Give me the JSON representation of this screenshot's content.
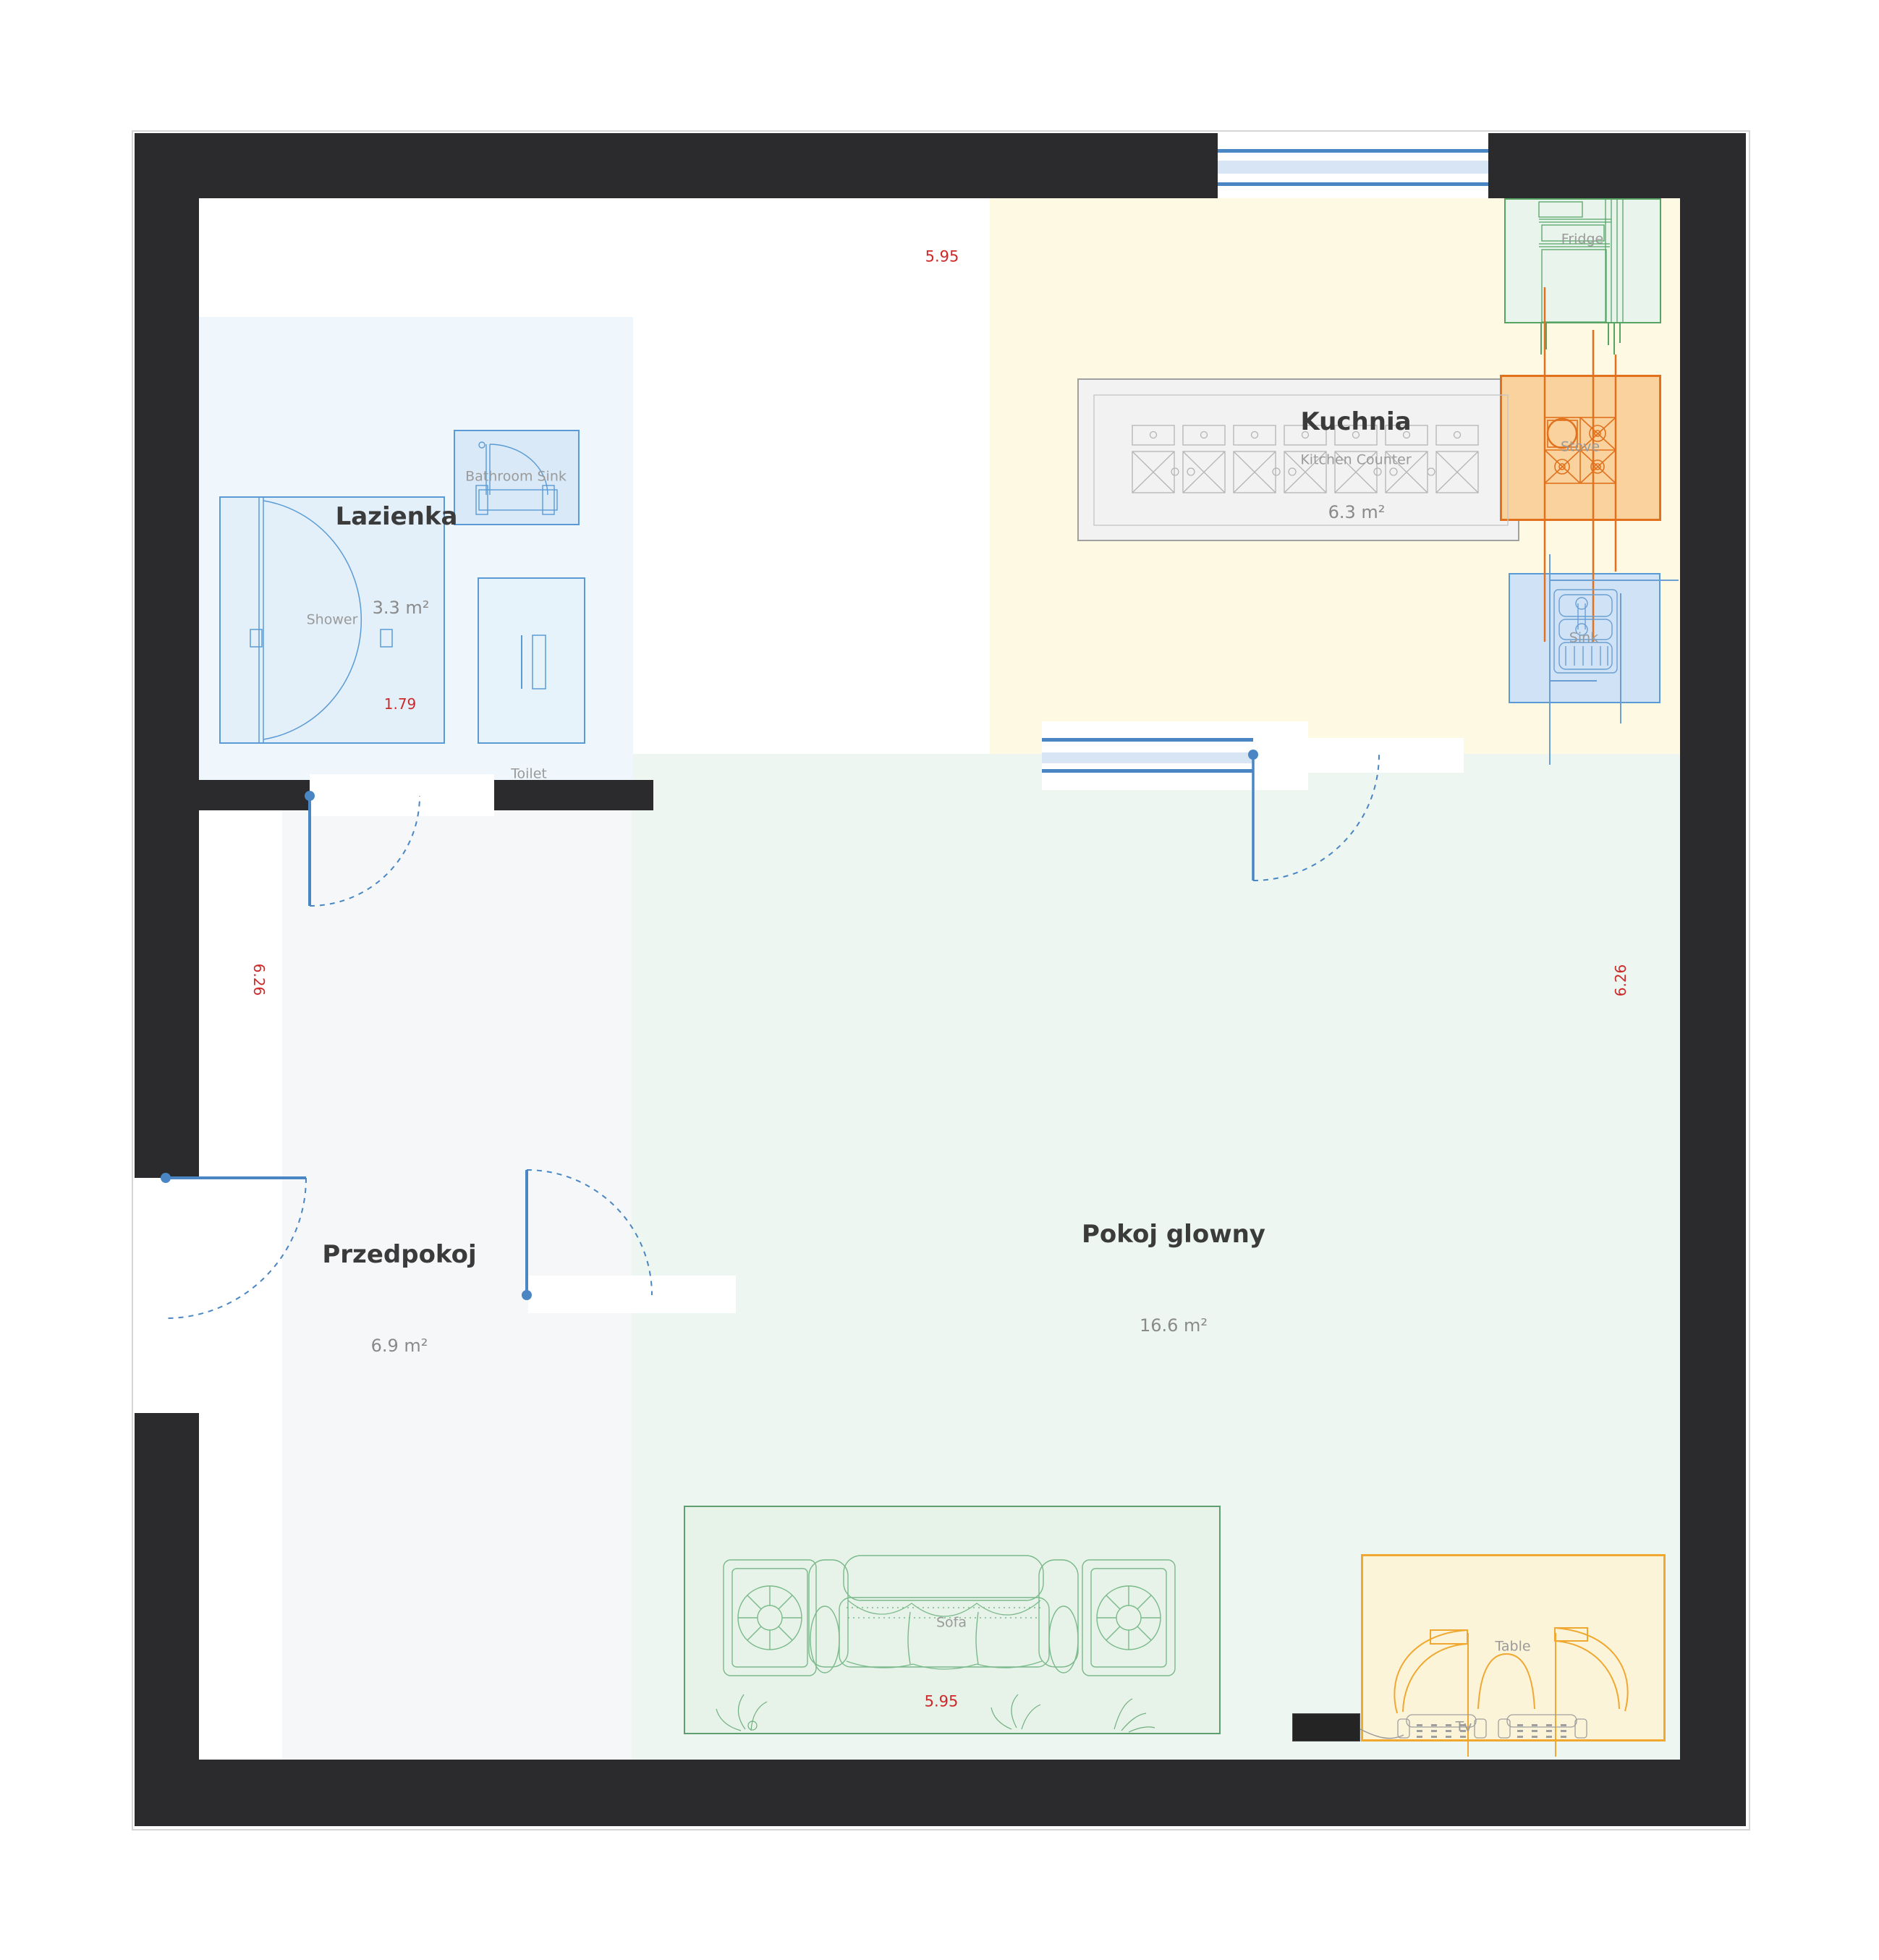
{
  "plan": {
    "rooms": [
      {
        "name": "Lazienka",
        "area": "3.3 m²"
      },
      {
        "name": "Kuchnia",
        "area": "6.3 m²"
      },
      {
        "name": "Przedpokoj",
        "area": "6.9 m²"
      },
      {
        "name": "Pokoj glowny",
        "area": "16.6 m²"
      }
    ],
    "furniture": {
      "shower": "Shower",
      "bathroom_sink": "Bathroom Sink",
      "toilet": "Toilet",
      "kitchen_counter": "Kitchen Counter",
      "stove": "Stove",
      "sink": "Sink",
      "fridge": "Fridge",
      "sofa": "Sofa",
      "table": "Table",
      "tv": "Tv"
    },
    "dimensions": {
      "top_width": "5.95",
      "shower_width": "1.79",
      "left_height": "6.26",
      "right_height": "6.26",
      "sofa_width": "5.95"
    },
    "colors": {
      "wall": "#2b2b2d",
      "dimension_text": "#cc2a2a",
      "door_window_blue": "#4a86c4",
      "bathroom_accent": "#5b9bd5",
      "kitchen_floor": "#fdf9e3",
      "living_floor": "#edf6f0",
      "hall_floor": "#f6f7f8",
      "bathroom_floor": "#eff7fc",
      "stove_accent": "#e2711d",
      "table_accent": "#f0a830",
      "fridge_accent": "#56a364",
      "sofa_accent": "#5f9e6e"
    }
  }
}
